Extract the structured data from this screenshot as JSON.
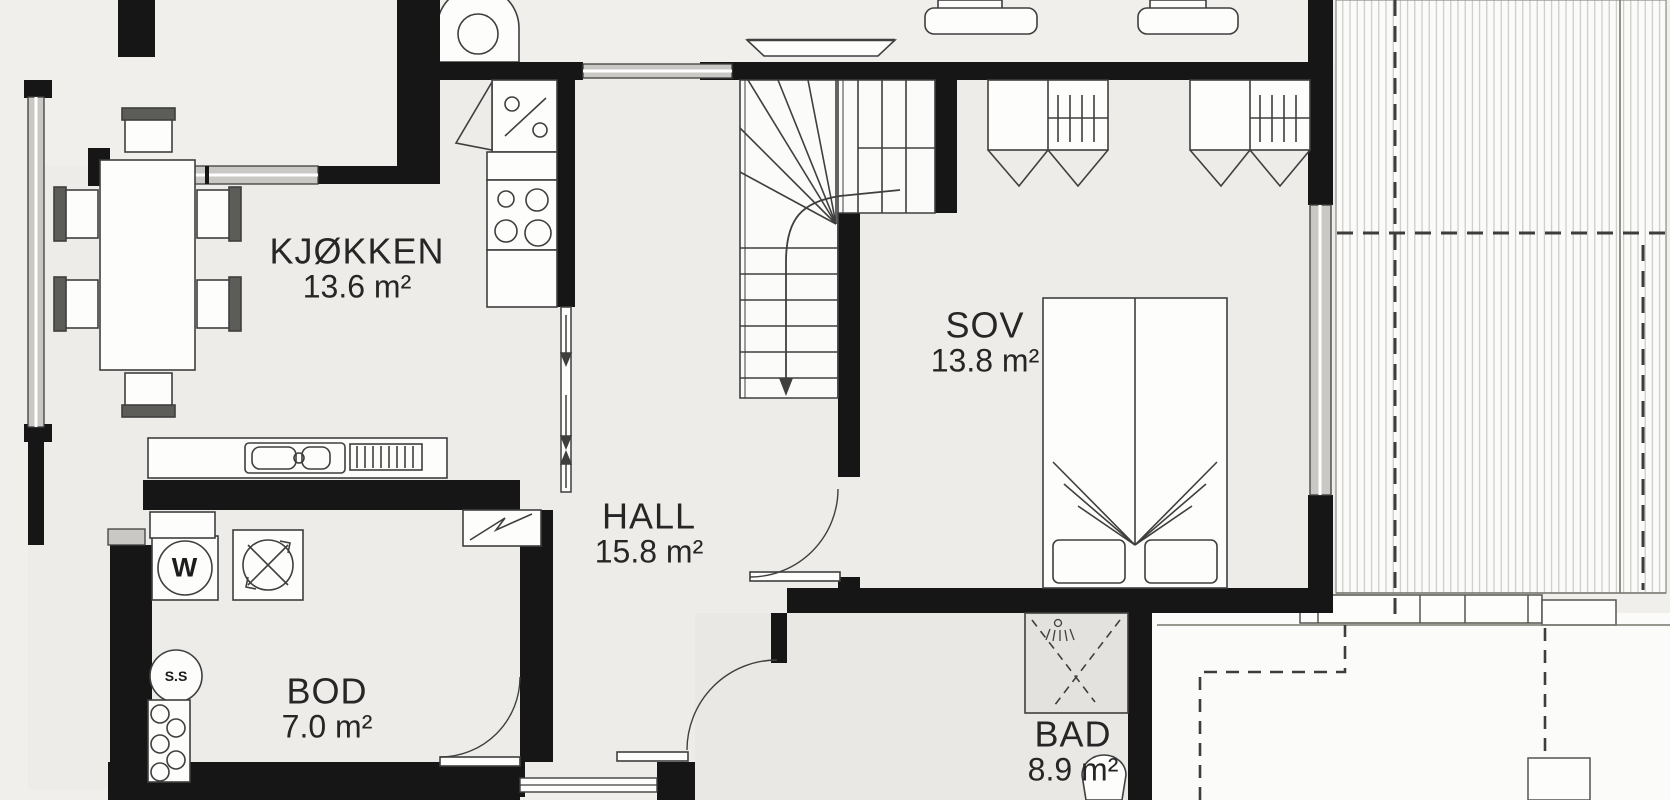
{
  "plan_title": "floor-plan",
  "rooms": {
    "kitchen": {
      "name": "KJØKKEN",
      "area": "13.6 m²"
    },
    "bedroom": {
      "name": "SOV",
      "area": "13.8 m²"
    },
    "hall": {
      "name": "HALL",
      "area": "15.8 m²"
    },
    "storage": {
      "name": "BOD",
      "area": "7.0 m²"
    },
    "bathroom": {
      "name": "BAD",
      "area": "8.9 m²"
    }
  },
  "symbols": {
    "washing_machine": "W",
    "floor_drain": "S.S"
  },
  "colors": {
    "wall": "#161616",
    "background": "#f0efeb",
    "floor": "#edece8",
    "bath_floor": "#e9e8e4",
    "window_fill": "#c9c8c4",
    "deck_background": "#fbfbf9",
    "deck_plank_line": "#c6c5c1",
    "dashed_line": "#3d3d3d",
    "furniture_line": "#3f3f3f",
    "text": "#262626"
  }
}
